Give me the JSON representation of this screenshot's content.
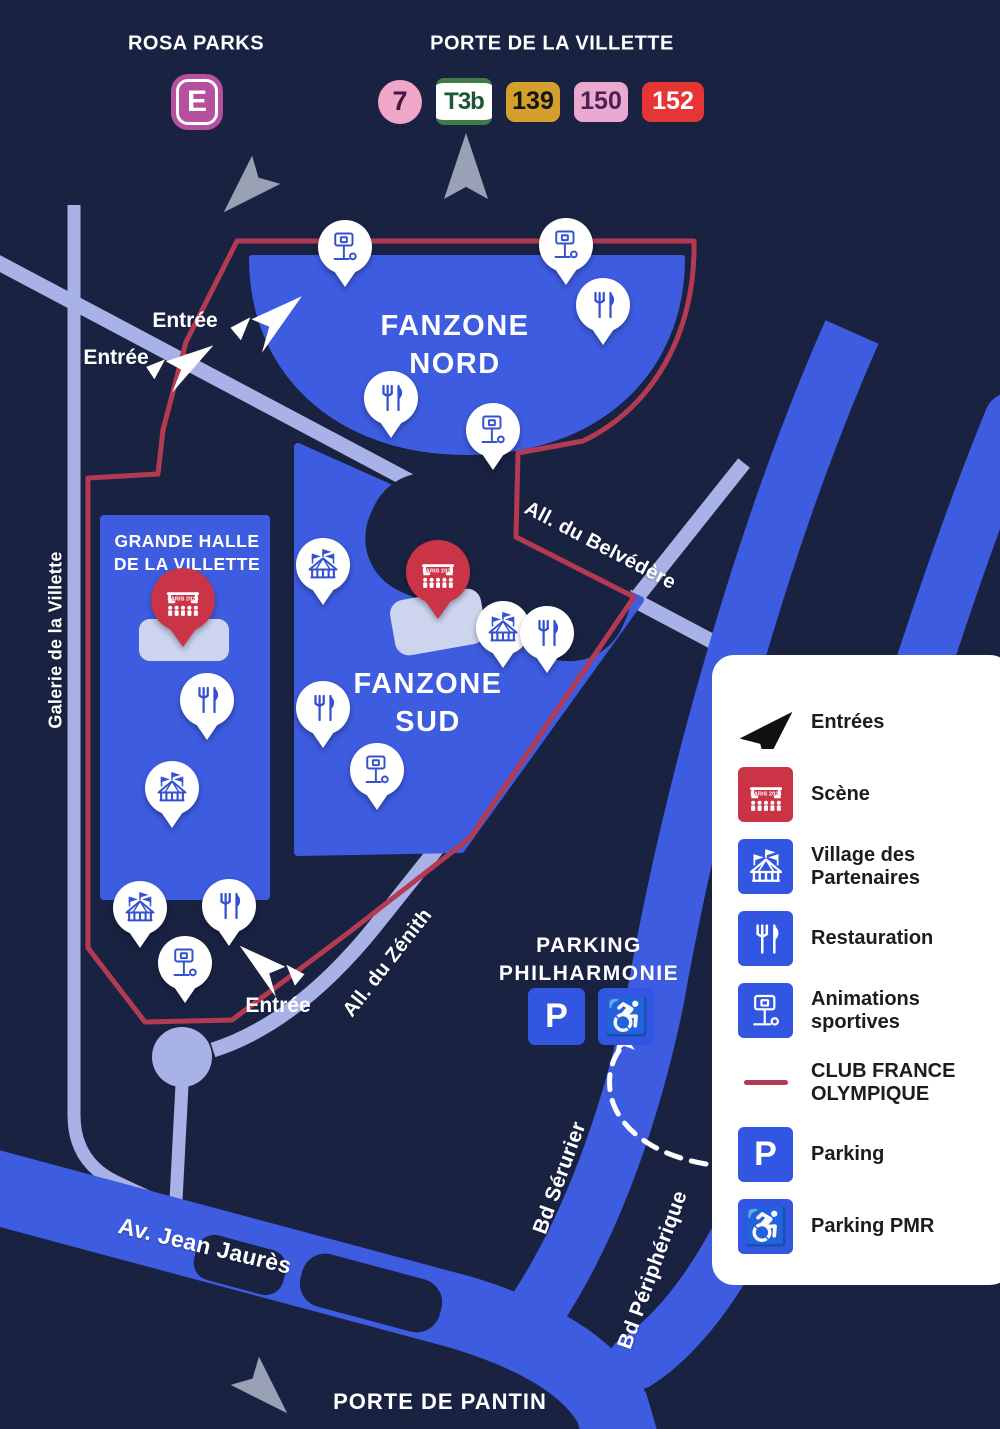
{
  "colors": {
    "background": "#1a2242",
    "zone_blue": "#3d5ce0",
    "road_blue": "#3d5ce0",
    "road_lavender": "#a8b2e6",
    "route_red": "#b43a52",
    "scene_red": "#cb3347",
    "legend_blue": "#3356e2",
    "pin_icon_blue": "#3452cf",
    "stage_platform": "#ccd4ee",
    "arrow_grey": "#99a1b4",
    "dark_blob": "#1a2242"
  },
  "header": {
    "rosa_parks": {
      "name": "ROSA PARKS",
      "badges": [
        {
          "style": "rer-e",
          "label": "E"
        }
      ]
    },
    "porte_de_la_villette": {
      "name": "PORTE DE LA VILLETTE",
      "badges": [
        {
          "style": "metro-7",
          "label": "7"
        },
        {
          "style": "tram-t3b",
          "label": "T3b"
        },
        {
          "style": "bus-139",
          "label": "139"
        },
        {
          "style": "bus-150",
          "label": "150"
        },
        {
          "style": "bus-152",
          "label": "152"
        }
      ]
    }
  },
  "zones": {
    "nord_line1": "FANZONE",
    "nord_line2": "NORD",
    "sud_line1": "FANZONE",
    "sud_line2": "SUD",
    "halle_line1": "GRANDE HALLE",
    "halle_line2": "DE LA VILLETTE"
  },
  "streets": {
    "galerie": "Galerie de la Villette",
    "belvedere": "All. du Belvédère",
    "zenith": "All. du Zénith",
    "jean_jaures": "Av. Jean Jaurès",
    "serurier": "Bd Sérurier",
    "peripherique": "Bd Périphérique"
  },
  "gates": {
    "porte_de_pantin": "PORTE DE PANTIN"
  },
  "parking": {
    "title_line1": "PARKING",
    "title_line2": "PHILHARMONIE",
    "p_label": "P",
    "pmr_glyph": "♿"
  },
  "entrance_label": "Entrée",
  "scene_pin_text": {
    "line1": "PARIS",
    "line2": "2024"
  },
  "pins": [
    {
      "type": "sports",
      "x": 345,
      "y": 247
    },
    {
      "type": "sports",
      "x": 566,
      "y": 245
    },
    {
      "type": "food",
      "x": 603,
      "y": 305
    },
    {
      "type": "food",
      "x": 391,
      "y": 398
    },
    {
      "type": "sports",
      "x": 493,
      "y": 430
    },
    {
      "type": "village",
      "x": 323,
      "y": 565
    },
    {
      "type": "stage",
      "x": 438,
      "y": 572
    },
    {
      "type": "village",
      "x": 503,
      "y": 628
    },
    {
      "type": "food",
      "x": 547,
      "y": 633
    },
    {
      "type": "food",
      "x": 323,
      "y": 708
    },
    {
      "type": "sports",
      "x": 377,
      "y": 770
    },
    {
      "type": "stage",
      "x": 183,
      "y": 600
    },
    {
      "type": "food",
      "x": 207,
      "y": 700
    },
    {
      "type": "village",
      "x": 172,
      "y": 788
    },
    {
      "type": "village",
      "x": 140,
      "y": 908
    },
    {
      "type": "food",
      "x": 229,
      "y": 906
    },
    {
      "type": "sports",
      "x": 185,
      "y": 963
    }
  ],
  "legend": {
    "items": [
      {
        "icon": "entrance",
        "label": "Entrées"
      },
      {
        "icon": "stage",
        "label": "Scène"
      },
      {
        "icon": "village",
        "label": "Village des Partenaires"
      },
      {
        "icon": "food",
        "label": "Restauration"
      },
      {
        "icon": "sports",
        "label": "Animations sportives"
      },
      {
        "icon": "route",
        "label": "CLUB FRANCE OLYMPIQUE"
      },
      {
        "icon": "parking",
        "label": "Parking"
      },
      {
        "icon": "pmr",
        "label": "Parking PMR"
      }
    ]
  }
}
